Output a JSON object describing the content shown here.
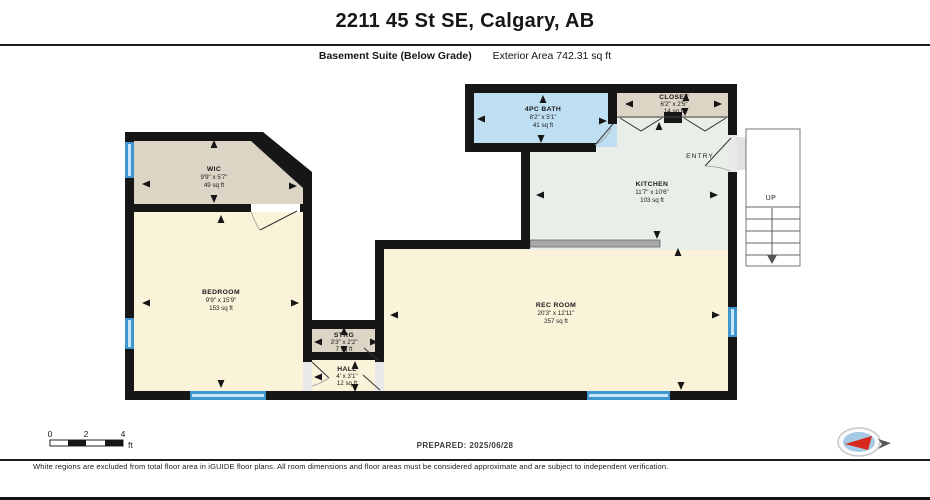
{
  "header": {
    "title": "2211 45 St SE, Calgary, AB",
    "floor_label": "Basement Suite (Below Grade)",
    "area_label": "Exterior Area 742.31 sq ft"
  },
  "rooms": [
    {
      "name": "WIC",
      "dims": "9'9\" x 5'7\"",
      "area": "49 sq ft"
    },
    {
      "name": "BEDROOM",
      "dims": "9'9\" x 15'9\"",
      "area": "153 sq ft"
    },
    {
      "name": "4PC BATH",
      "dims": "8'2\" x 5'1\"",
      "area": "41 sq ft"
    },
    {
      "name": "CLOSET",
      "dims": "6'2\" x 2'5\"",
      "area": "14 sq ft"
    },
    {
      "name": "KITCHEN",
      "dims": "11'7\" x 10'6\"",
      "area": "103 sq ft"
    },
    {
      "name": "REC ROOM",
      "dims": "20'3\" x 12'11\"",
      "area": "257 sq ft"
    },
    {
      "name": "STRG",
      "dims": "3'3\" x 2'2\"",
      "area": "7 sq ft"
    },
    {
      "name": "HALL",
      "dims": "4' x 3'1\"",
      "area": "12 sq ft"
    }
  ],
  "labels": {
    "entry": "ENTRY",
    "up": "UP"
  },
  "scale_bar": {
    "ticks": [
      "0",
      "2",
      "4"
    ],
    "unit": "ft"
  },
  "footer": {
    "prepared": "PREPARED: 2025/06/28",
    "disclaimer": "White regions are excluded from total floor area in iGUIDE floor plans. All room dimensions and floor areas must be considered approximate and are subject to independent verification."
  },
  "colors": {
    "wall": "#161616",
    "cream": "#faf3d9",
    "tan": "#dcd4c5",
    "bath_blue": "#bedff2",
    "mint": "#e7efe8",
    "window": "#3d96cf",
    "window_stripe": "#c9e6f6",
    "counter": "#a8a8a8",
    "needle_red": "#d8281e",
    "compass_blue": "#a6c9e4"
  }
}
